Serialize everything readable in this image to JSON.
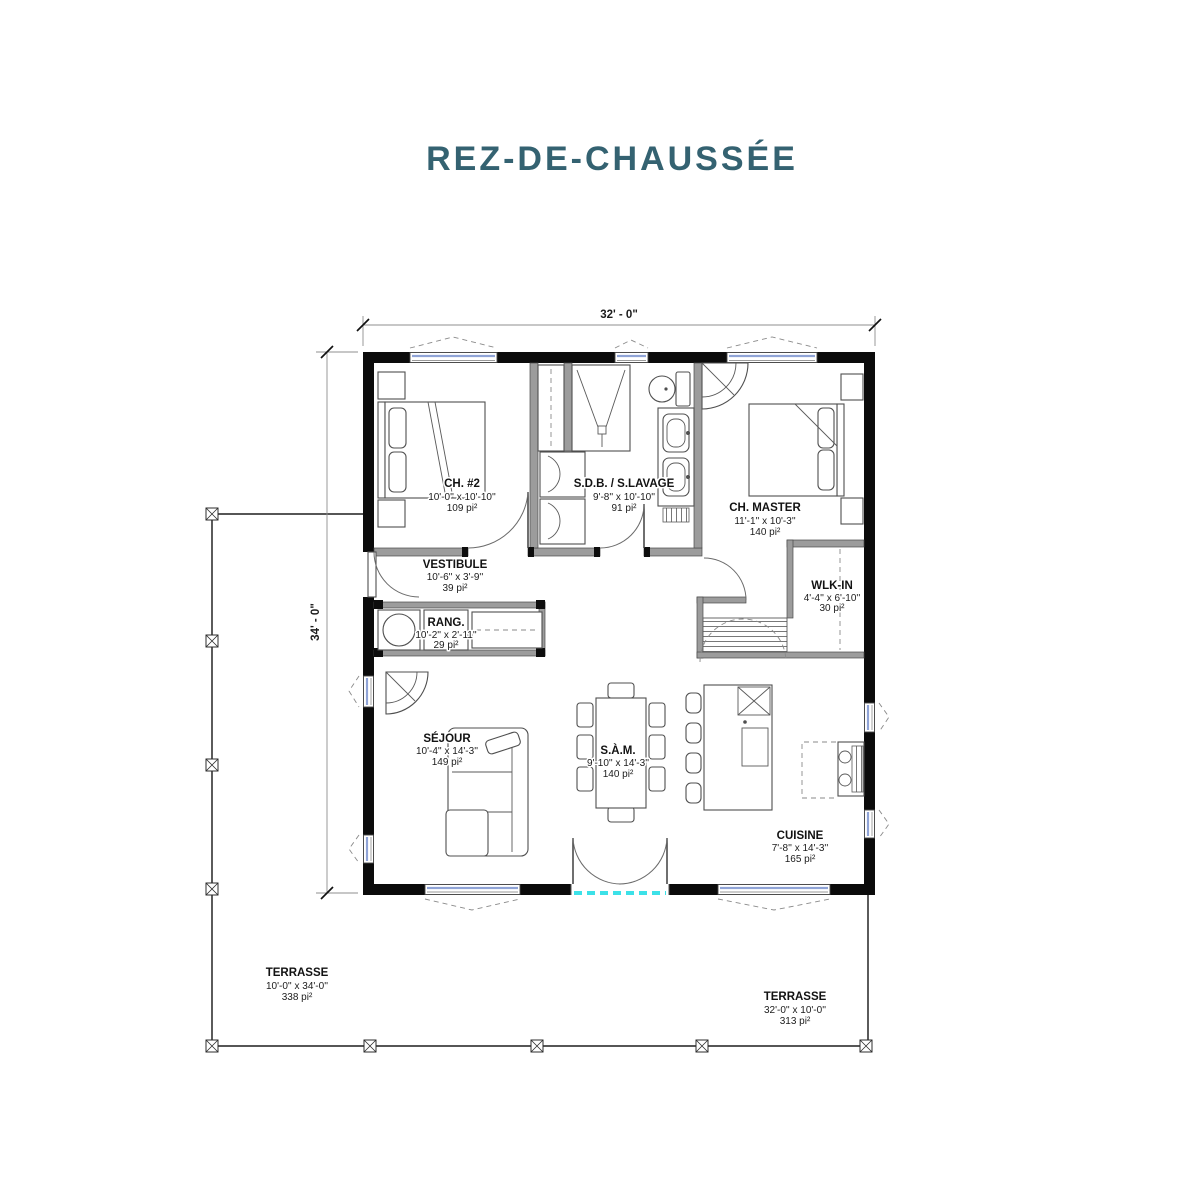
{
  "page": {
    "title": "REZ-DE-CHAUSSÉE"
  },
  "colors": {
    "title": "#346271",
    "wall": "#0b0b0b",
    "interior_wall": "#9c9c9c",
    "window_glass": "#8fa3d6",
    "patio_threshold": "#3ce1e8"
  },
  "dimensions": {
    "top": "32' - 0\"",
    "left": "34' - 0\""
  },
  "rooms": [
    {
      "name": "CH. #2",
      "dims": "10'-0'' x 10'-10''",
      "area": "109 pi²"
    },
    {
      "name": "S.D.B. / S.LAVAGE",
      "dims": "9'-8'' x 10'-10''",
      "area": "91 pi²"
    },
    {
      "name": "CH. MASTER",
      "dims": "11'-1'' x 10'-3''",
      "area": "140 pi²"
    },
    {
      "name": "VESTIBULE",
      "dims": "10'-6'' x 3'-9''",
      "area": "39 pi²"
    },
    {
      "name": "RANG.",
      "dims": "10'-2'' x 2'-11''",
      "area": "29 pi²"
    },
    {
      "name": "WLK-IN",
      "dims": "4'-4'' x 6'-10''",
      "area": "30 pi²"
    },
    {
      "name": "SÉJOUR",
      "dims": "10'-4'' x 14'-3''",
      "area": "149 pi²"
    },
    {
      "name": "S.À.M.",
      "dims": "9'-10'' x 14'-3''",
      "area": "140 pi²"
    },
    {
      "name": "CUISINE",
      "dims": "7'-8'' x 14'-3''",
      "area": "165 pi²"
    }
  ],
  "terraces": [
    {
      "name": "TERRASSE",
      "dims": "10'-0'' x 34'-0''",
      "area": "338 pi²"
    },
    {
      "name": "TERRASSE",
      "dims": "32'-0'' x 10'-0''",
      "area": "313 pi²"
    }
  ]
}
